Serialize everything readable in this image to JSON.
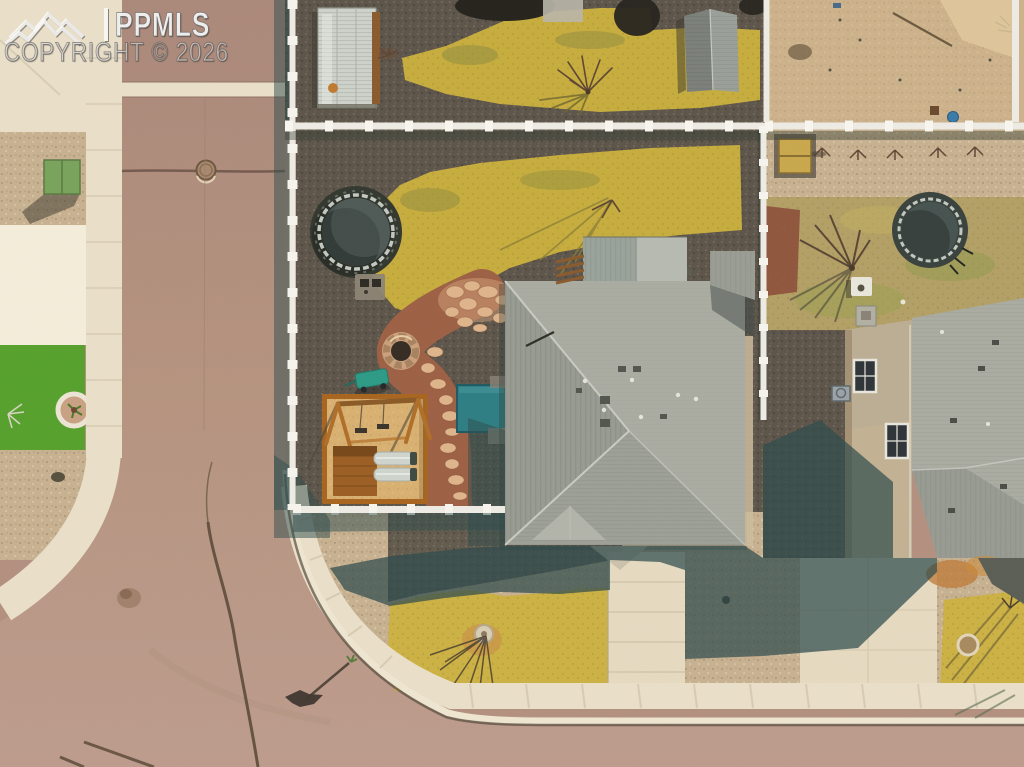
{
  "image": {
    "type": "aerial-drone-photo",
    "subject": "Overhead aerial view of a residential corner-lot home with gray hip roof, xeriscaped backyard with trampoline, flagstone path, fire pit and wooden swing set, surrounded by neighboring houses, white vinyl fences and a curving street"
  },
  "watermark": {
    "brand": "PPMLS",
    "copyright": "COPYRIGHT © 2026",
    "logo": "mountain-range-icon"
  },
  "palette": {
    "road": "#b3907f",
    "roadJoint": "#6b5246",
    "concrete": "#eadfc9",
    "concreteBright": "#f3edda",
    "curbShadow": "#54483a",
    "gravelLight": "#c7b190",
    "gravelDark": "#5d554a",
    "turfGreen": "#56a12d",
    "utilityGreen": "#79a35c",
    "grassYellow": "#c7ad3e",
    "grassOlive": "#8f8c3f",
    "grassFront": "#ccb144",
    "tramMat": "#475350",
    "tramRim": "#c2c8c0",
    "flagDirt": "#9d6045",
    "flagStone": "#dfb48b",
    "sand": "#d9b171",
    "wood": "#b06f2a",
    "slideGray": "#cfd4cd",
    "tealToy": "#2d9b86",
    "tealWell": "#2e7e83",
    "roofLight": "#aaaca2",
    "roofMid": "#989b91",
    "roofLine": "#c9cbc2",
    "shadowTeal": "#2e4b4c",
    "fenceWhite": "#edebe3",
    "wallTan": "#c3b194",
    "windowPane": "#2f3438",
    "dirtSand": "#cdb28b",
    "sandBright": "#e0c79c",
    "driveLit": "#e6dbc1",
    "greenhouseGray": "#cdd2cb",
    "shedGray": "#9aa099",
    "treeDark": "#26231d",
    "twigBrown": "#5f4634"
  }
}
